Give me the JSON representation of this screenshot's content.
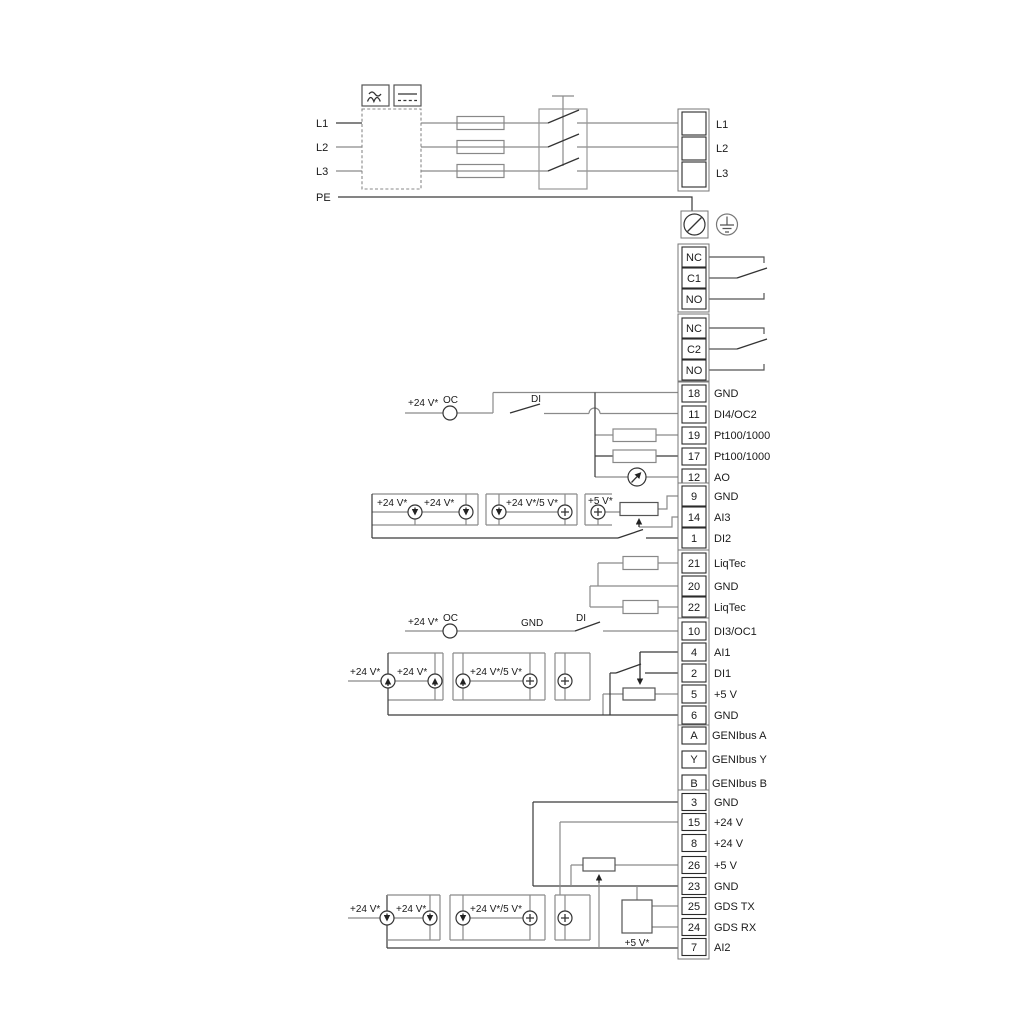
{
  "colors": {
    "wire": "#8a8a8a",
    "wire_dark": "#3a3a3a",
    "text": "#1a1a1a",
    "background": "#ffffff"
  },
  "mains": {
    "l1": "L1",
    "l2": "L2",
    "l3": "L3",
    "pe": "PE"
  },
  "power_block": {
    "rows": [
      "L1",
      "L2",
      "L3"
    ]
  },
  "relay1": {
    "rows": [
      "NC",
      "C1",
      "NO"
    ]
  },
  "relay2": {
    "rows": [
      "NC",
      "C2",
      "NO"
    ]
  },
  "strip_a": {
    "rows": [
      {
        "num": "18",
        "label": "GND"
      },
      {
        "num": "11",
        "label": "DI4/OC2"
      },
      {
        "num": "19",
        "label": "Pt100/1000"
      },
      {
        "num": "17",
        "label": "Pt100/1000"
      },
      {
        "num": "12",
        "label": "AO"
      }
    ]
  },
  "strip_b": {
    "rows": [
      {
        "num": "9",
        "label": "GND"
      },
      {
        "num": "14",
        "label": "AI3"
      },
      {
        "num": "1",
        "label": "DI2"
      }
    ]
  },
  "strip_c": {
    "rows": [
      {
        "num": "21",
        "label": "LiqTec"
      },
      {
        "num": "20",
        "label": "GND"
      },
      {
        "num": "22",
        "label": "LiqTec"
      }
    ]
  },
  "strip_d": {
    "rows": [
      {
        "num": "10",
        "label": "DI3/OC1"
      },
      {
        "num": "4",
        "label": "AI1"
      },
      {
        "num": "2",
        "label": "DI1"
      },
      {
        "num": "5",
        "label": "+5 V"
      },
      {
        "num": "6",
        "label": "GND"
      }
    ]
  },
  "genibus": {
    "rows": [
      {
        "num": "A",
        "label": "GENIbus A"
      },
      {
        "num": "Y",
        "label": "GENIbus Y"
      },
      {
        "num": "B",
        "label": "GENIbus B"
      }
    ]
  },
  "strip_g": {
    "rows": [
      {
        "num": "3",
        "label": "GND"
      },
      {
        "num": "15",
        "label": "+24 V"
      },
      {
        "num": "8",
        "label": "+24 V"
      },
      {
        "num": "26",
        "label": "+5 V"
      },
      {
        "num": "23",
        "label": "GND"
      },
      {
        "num": "25",
        "label": "GDS TX"
      },
      {
        "num": "24",
        "label": "GDS RX"
      },
      {
        "num": "7",
        "label": "AI2"
      }
    ]
  },
  "ann": {
    "di4": {
      "v24": "+24 V*",
      "oc": "OC",
      "di": "DI"
    },
    "ai3": {
      "v24a": "+24 V*",
      "v24b": "+24 V*",
      "v24_5": "+24 V*/5 V*",
      "v5": "+5 V*"
    },
    "di3": {
      "v24": "+24 V*",
      "oc": "OC",
      "gnd": "GND",
      "di": "DI"
    },
    "ai1": {
      "v24a": "+24 V*",
      "v24b": "+24 V*",
      "v24_5": "+24 V*/5 V*"
    },
    "ai2": {
      "v24a": "+24 V*",
      "v24b": "+24 V*",
      "v24_5": "+24 V*/5 V*",
      "v5": "+5 V*"
    }
  }
}
